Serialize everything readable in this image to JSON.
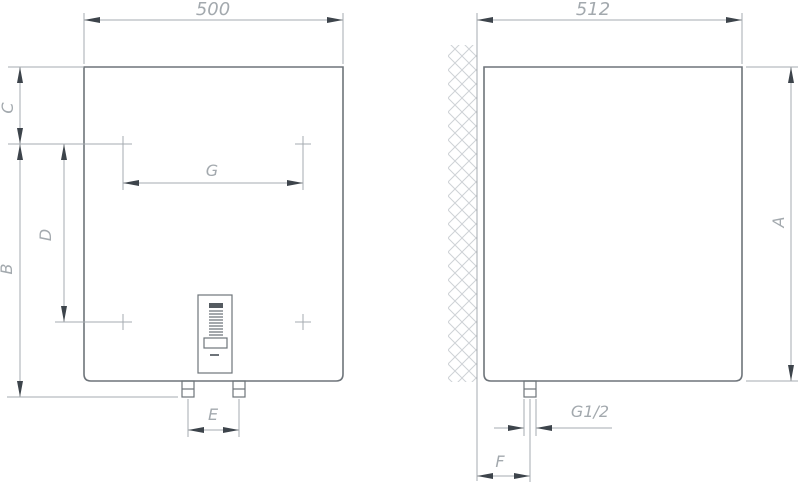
{
  "colors": {
    "background": "#ffffff",
    "outline": "#6e747a",
    "dimension": "#a6abb0",
    "arrow": "#3d444b",
    "label": "#a3a9ae",
    "hatch": "#ced2d6",
    "panel_dark": "#555b61"
  },
  "front_view": {
    "width_label": "500",
    "top_offset_label": "C",
    "height_label": "B",
    "bracket_vertical_label": "D",
    "bracket_horizontal_label": "G",
    "pipe_spacing_label": "E"
  },
  "side_view": {
    "depth_label": "512",
    "height_label": "A",
    "pipe_thread_label": "G1/2",
    "wall_offset_label": "F"
  }
}
